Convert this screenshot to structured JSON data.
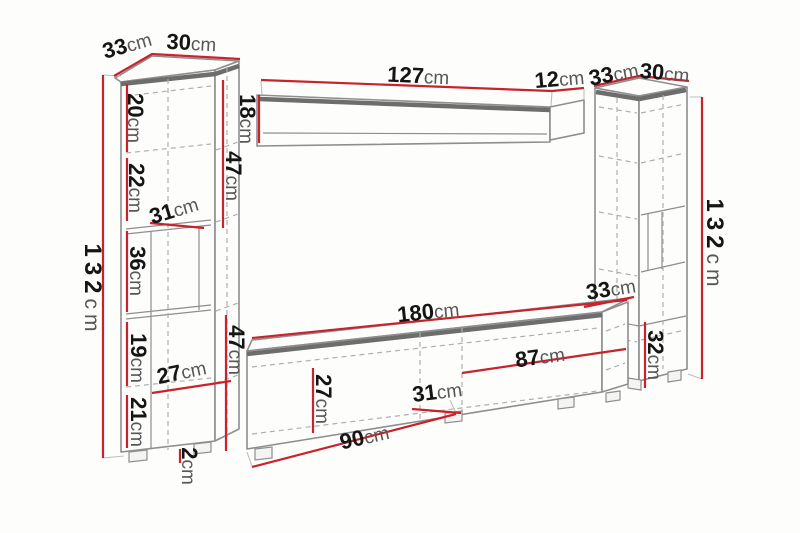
{
  "diagram": {
    "type": "furniture-dimension-diagram",
    "unit": "cm",
    "colors": {
      "dimension_line": "#c8232c",
      "outline": "#8e8e8e",
      "value_text": "#151515",
      "unit_text": "#575757",
      "background": "#fdfdfc"
    },
    "left_cabinet": {
      "depth_top": {
        "value": "33",
        "unit": "cm"
      },
      "width_top": {
        "value": "30",
        "unit": "cm"
      },
      "height": {
        "value": "132",
        "unit": "cm"
      },
      "upper_section": {
        "value": "47",
        "unit": "cm"
      },
      "section_1": {
        "value": "20",
        "unit": "cm"
      },
      "section_2": {
        "value": "22",
        "unit": "cm"
      },
      "shelf_depth": {
        "value": "31",
        "unit": "cm"
      },
      "section_3": {
        "value": "36",
        "unit": "cm"
      },
      "section_4": {
        "value": "19",
        "unit": "cm"
      },
      "inner_depth": {
        "value": "27",
        "unit": "cm"
      },
      "section_5": {
        "value": "21",
        "unit": "cm"
      },
      "plinth_height": {
        "value": "2",
        "unit": "cm"
      }
    },
    "wall_shelf": {
      "width": {
        "value": "127",
        "unit": "cm"
      },
      "depth": {
        "value": "12",
        "unit": "cm"
      },
      "height": {
        "value": "18",
        "unit": "cm"
      }
    },
    "right_cabinet": {
      "depth_top": {
        "value": "33",
        "unit": "cm"
      },
      "width_top": {
        "value": "30",
        "unit": "cm"
      },
      "height": {
        "value": "132",
        "unit": "cm"
      },
      "lower_depth": {
        "value": "33",
        "unit": "cm"
      },
      "base_section": {
        "value": "32",
        "unit": "cm"
      }
    },
    "tv_stand": {
      "width": {
        "value": "180",
        "unit": "cm"
      },
      "right_section": {
        "value": "87",
        "unit": "cm"
      },
      "left_section": {
        "value": "90",
        "unit": "cm"
      },
      "front_height": {
        "value": "27",
        "unit": "cm"
      },
      "inner_depth": {
        "value": "31",
        "unit": "cm"
      },
      "height": {
        "value": "47",
        "unit": "cm"
      }
    }
  }
}
